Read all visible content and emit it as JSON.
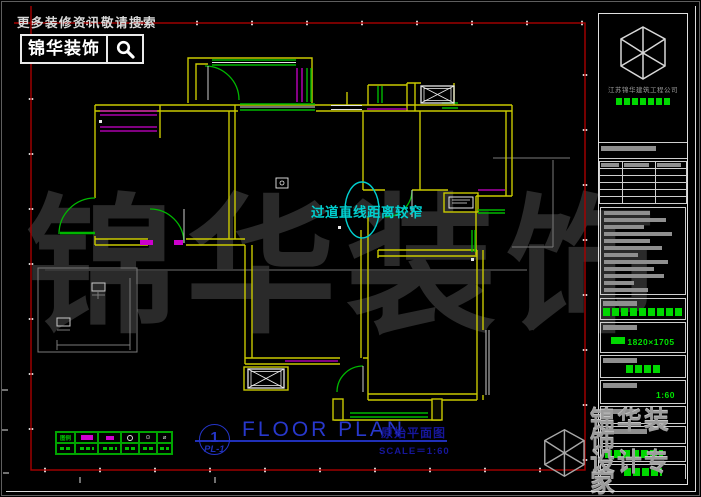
{
  "header": {
    "slogan": "更多装修资讯敬请搜索",
    "brand": "锦华装饰"
  },
  "annotation": {
    "text": "过道直线距离较窄"
  },
  "watermark": {
    "chars": [
      "锦",
      "华",
      "装",
      "饰"
    ]
  },
  "drawing_title": {
    "number": "1",
    "sheet": "PL-1",
    "title_en": "FLOOR PLAN",
    "title_cn": "原始平面图",
    "scale": "SCALE＝1:60"
  },
  "legend": {
    "label": "图例"
  },
  "title_block": {
    "company": "江苏锦华建筑工程公司",
    "dimensions": "1820×1705",
    "scale": "1:60"
  },
  "brand_watermark": {
    "line1": "锦华装饰",
    "line2": "设计专家",
    "url": "WWW.JS-JINHUA.COM"
  },
  "colors": {
    "wall": "#c9c900",
    "window": "#00b800",
    "bay": "#cc00cc",
    "annotation": "#00d0d0",
    "sheet_border": "#a80000",
    "title_blue": "#2838cc",
    "green_text": "#00e400"
  }
}
